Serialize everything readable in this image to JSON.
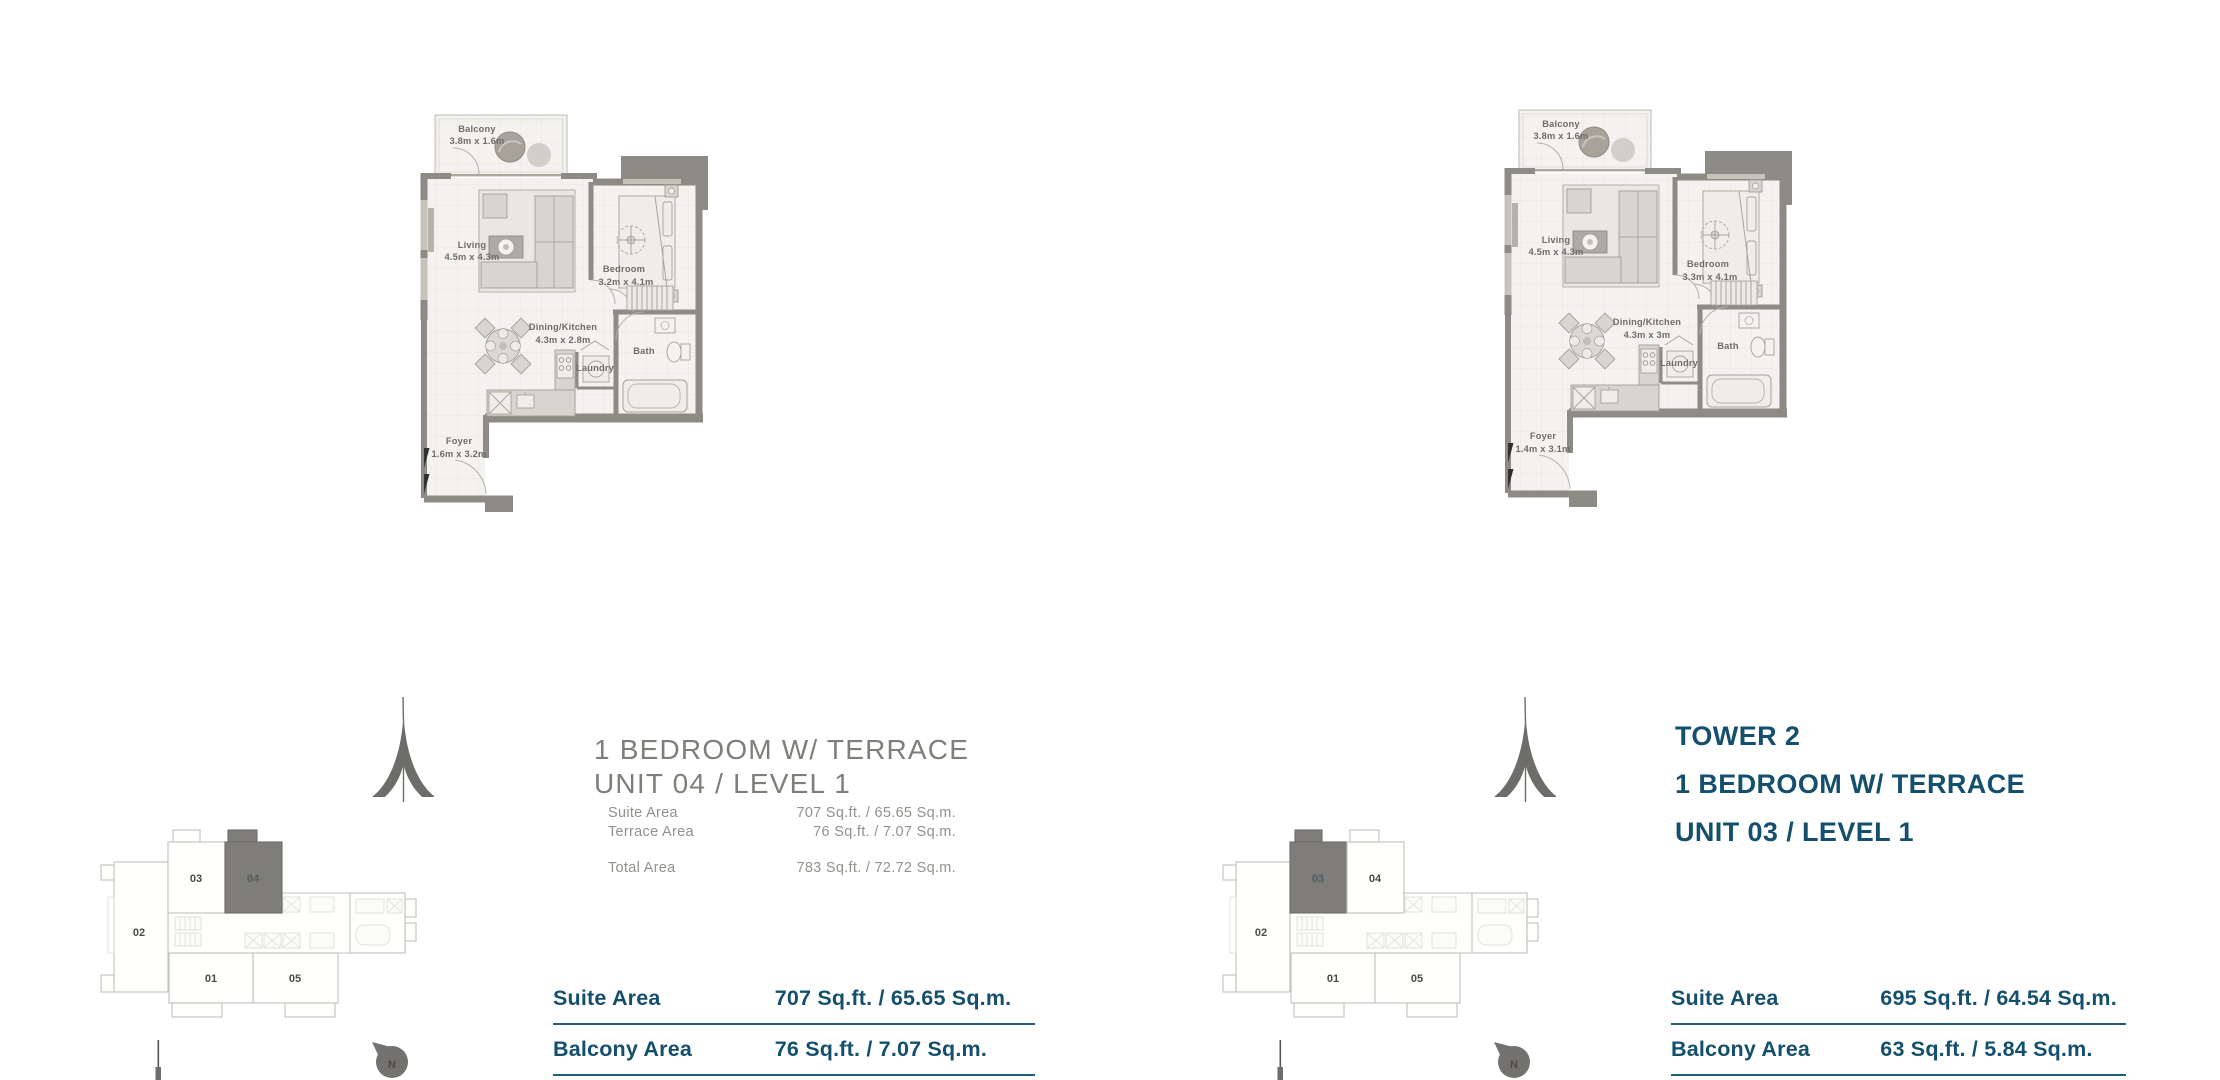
{
  "page": {
    "background": "#ffffff"
  },
  "colors": {
    "teal": "#14506e",
    "table_line": "#1f6080",
    "title_gray": "#817e79",
    "detail_gray": "#94918c",
    "wall_gray": "#8e8b84",
    "plan_label_gray": "#6f6d68",
    "highlight_gray": "#7f7d79"
  },
  "units": [
    {
      "side": "left",
      "title_lines": [
        "1 BEDROOM W/ TERRACE",
        "UNIT 04 / LEVEL 1"
      ],
      "area_details": [
        {
          "label": "Suite Area",
          "value": "707 Sq.ft. / 65.65 Sq.m."
        },
        {
          "label": "Terrace Area",
          "value": "76 Sq.ft. / 7.07 Sq.m."
        },
        {
          "label": "Total Area",
          "value": "783 Sq.ft. / 72.72 Sq.m."
        }
      ],
      "area_table": [
        {
          "label": "Suite Area",
          "value": "707 Sq.ft. / 65.65 Sq.m."
        },
        {
          "label": "Balcony Area",
          "value": "76 Sq.ft. / 7.07 Sq.m."
        }
      ],
      "plan": {
        "balcony_name": "Balcony",
        "balcony_dim": "3.8m x 1.6m",
        "living_name": "Living",
        "living_dim": "4.5m x 4.3m",
        "bedroom_name": "Bedroom",
        "bedroom_dim": "3.2m x 4.1m",
        "dining_name": "Dining/Kitchen",
        "dining_dim": "4.3m x 2.8m",
        "bath_name": "Bath",
        "laundry_name": "Laundry",
        "foyer_name": "Foyer",
        "foyer_dim": "1.6m x 3.2m"
      },
      "keyplan": {
        "u01": "01",
        "u02": "02",
        "u03": "03",
        "u04": "04",
        "u05": "05",
        "highlighted": "04",
        "north": "N"
      }
    },
    {
      "side": "right",
      "title_lines": [
        "TOWER 2",
        "1 BEDROOM W/ TERRACE",
        "UNIT 03 / LEVEL 1"
      ],
      "area_details": [],
      "area_table": [
        {
          "label": "Suite Area",
          "value": "695 Sq.ft. / 64.54 Sq.m."
        },
        {
          "label": "Balcony Area",
          "value": "63 Sq.ft. / 5.84 Sq.m."
        }
      ],
      "plan": {
        "balcony_name": "Balcony",
        "balcony_dim": "3.8m x 1.6m",
        "living_name": "Living",
        "living_dim": "4.5m x 4.3m",
        "bedroom_name": "Bedroom",
        "bedroom_dim": "3.3m x 4.1m",
        "dining_name": "Dining/Kitchen",
        "dining_dim": "4.3m x 3m",
        "bath_name": "Bath",
        "laundry_name": "Laundry",
        "foyer_name": "Foyer",
        "foyer_dim": "1.4m x 3.1m"
      },
      "keyplan": {
        "u01": "01",
        "u02": "02",
        "u03": "03",
        "u04": "04",
        "u05": "05",
        "highlighted": "03",
        "north": "N"
      }
    }
  ]
}
